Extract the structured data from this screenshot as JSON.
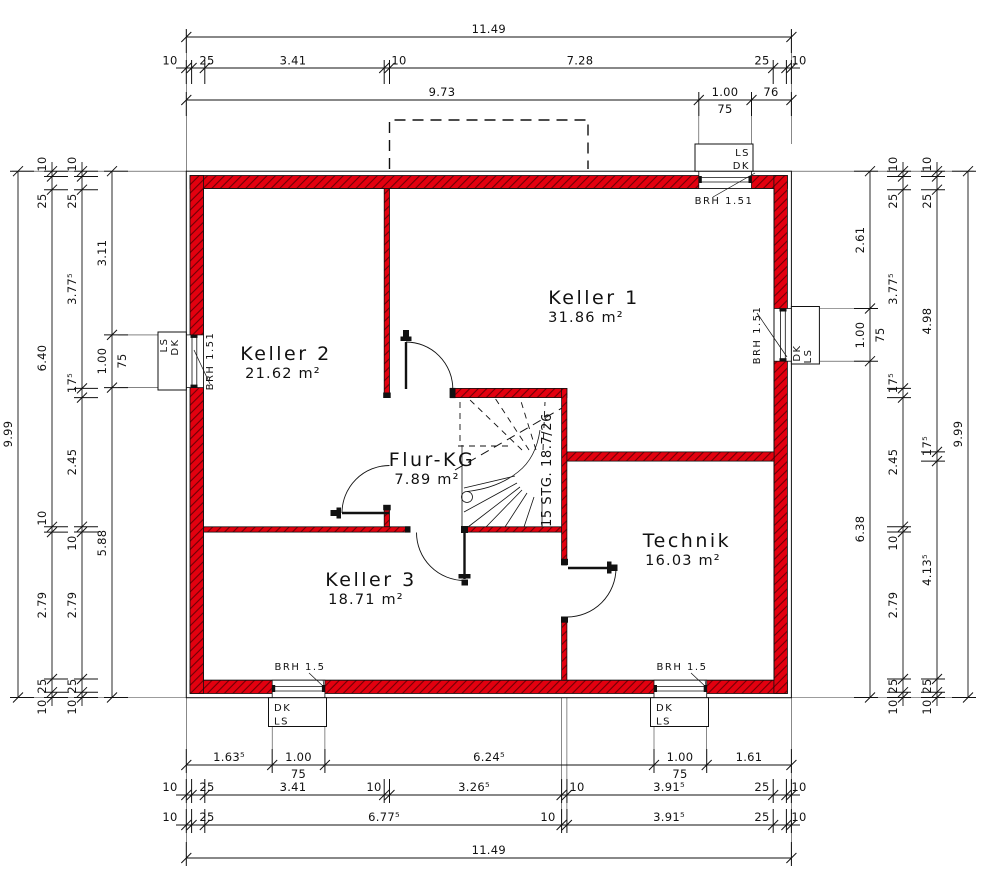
{
  "colors": {
    "wall_red": "#e3000f",
    "hatch_dark": "#6f0005",
    "line": "#1a1a1a"
  },
  "rooms": {
    "keller1": {
      "name": "Keller 1",
      "area": "31.86 m²"
    },
    "keller2": {
      "name": "Keller 2",
      "area": "21.62 m²"
    },
    "keller3": {
      "name": "Keller 3",
      "area": "18.71 m²"
    },
    "flur": {
      "name": "Flur-KG",
      "area": "7.89 m²"
    },
    "technik": {
      "name": "Technik",
      "area": "16.03 m²"
    }
  },
  "stair": {
    "label": "15 STG. 18.7/26"
  },
  "windows": {
    "top_right": {
      "a": "LS",
      "b": "DK",
      "brh": "BRH 1.51"
    },
    "left": {
      "a": "LS",
      "b": "DK",
      "brh": "BRH 1.51"
    },
    "right": {
      "a": "DK",
      "b": "LS",
      "brh": "BRH 1.51"
    },
    "bottom_left": {
      "a": "DK",
      "b": "LS",
      "brh": "BRH 1.5"
    },
    "bottom_right": {
      "a": "DK",
      "b": "LS",
      "brh": "BRH 1.5"
    }
  },
  "dims": {
    "t1": [
      "11.49"
    ],
    "t2": [
      "10",
      "25",
      "3.41",
      "10",
      "7.28",
      "25",
      "10"
    ],
    "t3": [
      "9.73",
      "1.00",
      "75",
      "76"
    ],
    "b1": [
      "1.63⁵",
      "1.00",
      "75",
      "6.24⁵",
      "1.00",
      "75",
      "1.61"
    ],
    "b2": [
      "10",
      "25",
      "3.41",
      "10",
      "3.26⁵",
      "10",
      "3.91⁵",
      "25",
      "10"
    ],
    "b3": [
      "10",
      "25",
      "6.77⁵",
      "10",
      "3.91⁵",
      "25",
      "10"
    ],
    "b4": [
      "11.49"
    ],
    "l1": [
      "9.99"
    ],
    "l2": [
      "10",
      "25",
      "6.40",
      "10",
      "2.79",
      "25",
      "10"
    ],
    "l3": [
      "10",
      "25",
      "3.77⁵",
      "17⁵",
      "2.45",
      "10",
      "2.79",
      "25",
      "10"
    ],
    "l4": [
      "3.11",
      "1.00",
      "75",
      "5.88"
    ],
    "r1": [
      "2.61",
      "1.00",
      "75",
      "6.38"
    ],
    "r2": [
      "10",
      "25",
      "3.77⁵",
      "17⁵",
      "2.45",
      "10",
      "2.79",
      "25",
      "10"
    ],
    "r3": [
      "10",
      "25",
      "4.98",
      "17⁵",
      "4.13⁵",
      "25",
      "10"
    ],
    "r4": [
      "9.99"
    ]
  }
}
